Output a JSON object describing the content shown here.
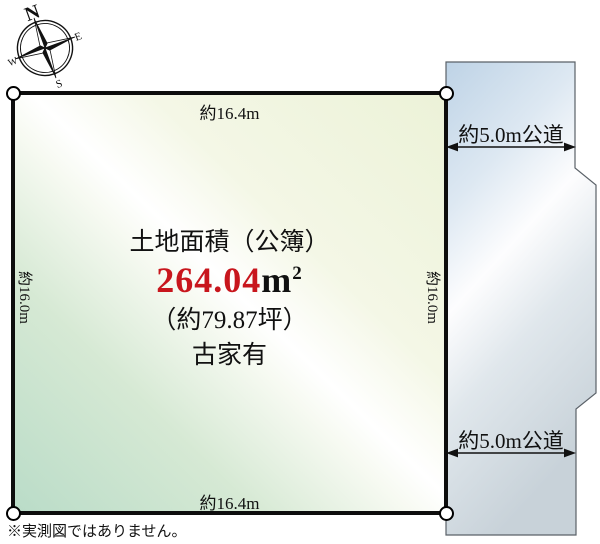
{
  "compass": {
    "north": "N",
    "east": "E",
    "south": "S",
    "west": "W"
  },
  "plot": {
    "dimension_top": "約16.4m",
    "dimension_bottom": "約16.4m",
    "dimension_left": "約16.0m",
    "dimension_right": "約16.0m",
    "area_title": "土地面積（公簿）",
    "area_value": "264.04",
    "area_unit": "m",
    "area_unit_exponent": "2",
    "area_tsubo": "（約79.87坪）",
    "building_status": "古家有"
  },
  "road": {
    "label_top": "約5.0m公道",
    "label_bottom": "約5.0m公道"
  },
  "footnote": "※実測図ではありません。",
  "colors": {
    "area_value_red": "#c8161d",
    "plot_fill_green": "#badcc8",
    "plot_fill_yellow": "#ecf2d8",
    "road_fill_blue": "#bed3e6",
    "outline_black": "#111111"
  }
}
